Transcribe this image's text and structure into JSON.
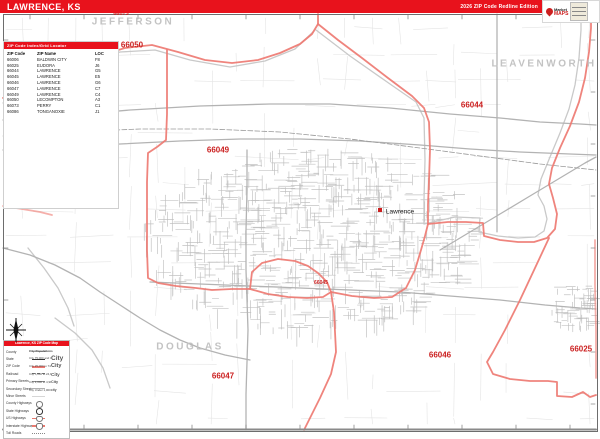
{
  "banner": {
    "title": "LAWRENCE, KS",
    "edition": "2026 ZIP Code Redline Edition",
    "color": "#e8121c"
  },
  "logo": {
    "brand_top": "Market",
    "brand_bottom": "MAPS"
  },
  "zip_table": {
    "header": "ZIP Code Index/Grid Locator",
    "columns": [
      "ZIP Code",
      "ZIP Name",
      "LOC"
    ],
    "rows": [
      [
        "66006",
        "BALDWIN CITY",
        "F8"
      ],
      [
        "66025",
        "EUDORA",
        "J6"
      ],
      [
        "66044",
        "LAWRENCE",
        "G5"
      ],
      [
        "66045",
        "LAWRENCE",
        "E5"
      ],
      [
        "66046",
        "LAWRENCE",
        "G6"
      ],
      [
        "66047",
        "LAWRENCE",
        "C7"
      ],
      [
        "66049",
        "LAWRENCE",
        "C4"
      ],
      [
        "66050",
        "LECOMPTON",
        "A3"
      ],
      [
        "66073",
        "PERRY",
        "C1"
      ],
      [
        "66086",
        "TONGANOXIE",
        "J1"
      ]
    ]
  },
  "legend": {
    "header": "Lawrence, KS ZIP Code Map",
    "items": [
      {
        "label": "County",
        "symbol": "county-line"
      },
      {
        "label": "State",
        "symbol": "state-line"
      },
      {
        "label": "ZIP Code",
        "symbol": "zip-line"
      },
      {
        "label": "Railroad",
        "symbol": "rail-line"
      },
      {
        "label": "Primary Streets",
        "symbol": "primary-line"
      },
      {
        "label": "Secondary Streets",
        "symbol": "secondary-line"
      },
      {
        "label": "Minor Streets",
        "symbol": "minor-line"
      },
      {
        "label": "County Highways",
        "symbol": "badge-oval"
      },
      {
        "label": "State Highways",
        "symbol": "badge-oval-dark"
      },
      {
        "label": "US Highways",
        "symbol": "badge-us"
      },
      {
        "label": "Interstate Highways",
        "symbol": "badge-interstate"
      },
      {
        "label": "Toll Roads",
        "symbol": "toll-line"
      }
    ],
    "city_section": {
      "title": "City Populations",
      "items": [
        {
          "label": "City 75,000 and Over",
          "sample": "City",
          "px": 6.5
        },
        {
          "label": "City 25,000 to 74,999",
          "sample": "City",
          "px": 5.5
        },
        {
          "label": "City 5,000 to 24,999",
          "sample": "City",
          "px": 4.6
        },
        {
          "label": "City 1,000 to 4,999",
          "sample": "City",
          "px": 3.8
        },
        {
          "label": "City Under 1,000",
          "sample": "city",
          "px": 3.2
        }
      ]
    }
  },
  "map": {
    "colors": {
      "boundary": "#ee7a72",
      "river": "#c9c9c9",
      "highway": "#b3b3b3",
      "railroad": "#9a9a9a",
      "county_line": "#a6a6a6",
      "rural": "#e4e4e4",
      "street": "#bcbcbc",
      "tick": "#8a8a8a",
      "zip_text": "#cb1f1f",
      "county_text": "#c3c3c3"
    },
    "counties": [
      {
        "name": "JEFFERSON",
        "x": 133,
        "y": 22
      },
      {
        "name": "LEAVENWORTH",
        "x": 544,
        "y": 64
      },
      {
        "name": "DOUGLAS",
        "x": 190,
        "y": 347
      }
    ],
    "zip_labels": [
      {
        "text": "66073",
        "x": 121,
        "y": 14,
        "size": 5.5
      },
      {
        "text": "66050",
        "x": 132,
        "y": 45,
        "size": 8
      },
      {
        "text": "66044",
        "x": 472,
        "y": 105,
        "size": 8
      },
      {
        "text": "66049",
        "x": 218,
        "y": 150,
        "size": 8
      },
      {
        "text": "66045",
        "x": 321,
        "y": 283,
        "size": 5
      },
      {
        "text": "66046",
        "x": 440,
        "y": 355,
        "size": 8
      },
      {
        "text": "66047",
        "x": 223,
        "y": 376,
        "size": 8
      },
      {
        "text": "66025",
        "x": 581,
        "y": 349,
        "size": 8
      }
    ],
    "city_labels": [
      {
        "text": "Lawrence",
        "x": 400,
        "y": 212
      }
    ],
    "city_markers": [
      {
        "x": 378,
        "y": 208
      }
    ],
    "boundaries": [
      [
        [
          3,
          98
        ],
        [
          25,
          88
        ],
        [
          48,
          76
        ],
        [
          72,
          66
        ],
        [
          98,
          56
        ],
        [
          125,
          48
        ],
        [
          152,
          45
        ],
        [
          178,
          52
        ],
        [
          205,
          60
        ],
        [
          232,
          63
        ],
        [
          258,
          60
        ],
        [
          280,
          53
        ],
        [
          300,
          44
        ],
        [
          312,
          34
        ],
        [
          318,
          24
        ],
        [
          318,
          14
        ]
      ],
      [
        [
          318,
          24
        ],
        [
          338,
          40
        ],
        [
          362,
          58
        ],
        [
          388,
          78
        ],
        [
          412,
          96
        ],
        [
          424,
          108
        ],
        [
          429,
          122
        ],
        [
          430,
          150
        ],
        [
          429,
          180
        ],
        [
          428,
          205
        ],
        [
          428,
          224
        ]
      ],
      [
        [
          167,
          50
        ],
        [
          167,
          82
        ],
        [
          167,
          114
        ],
        [
          166,
          140
        ],
        [
          157,
          147
        ],
        [
          148,
          153
        ],
        [
          147,
          182
        ],
        [
          147,
          216
        ],
        [
          147,
          250
        ],
        [
          148,
          278
        ],
        [
          158,
          283
        ],
        [
          176,
          286
        ],
        [
          196,
          288
        ],
        [
          212,
          290
        ],
        [
          232,
          289
        ],
        [
          250,
          289
        ]
      ],
      [
        [
          250,
          289
        ],
        [
          252,
          272
        ],
        [
          262,
          263
        ],
        [
          278,
          259
        ],
        [
          295,
          261
        ],
        [
          308,
          266
        ],
        [
          318,
          273
        ],
        [
          327,
          282
        ],
        [
          331,
          292
        ],
        [
          323,
          297
        ],
        [
          307,
          298
        ],
        [
          288,
          297
        ],
        [
          268,
          294
        ],
        [
          250,
          289
        ]
      ],
      [
        [
          331,
          292
        ],
        [
          334,
          312
        ],
        [
          335,
          332
        ],
        [
          336,
          352
        ],
        [
          331,
          374
        ],
        [
          320,
          398
        ],
        [
          310,
          418
        ],
        [
          304,
          430
        ]
      ],
      [
        [
          331,
          292
        ],
        [
          352,
          296
        ],
        [
          374,
          298
        ],
        [
          392,
          297
        ],
        [
          406,
          288
        ],
        [
          415,
          270
        ],
        [
          421,
          250
        ],
        [
          425,
          236
        ],
        [
          428,
          224
        ]
      ],
      [
        [
          428,
          224
        ],
        [
          448,
          222
        ],
        [
          466,
          222
        ],
        [
          483,
          223
        ],
        [
          484,
          236
        ],
        [
          500,
          240
        ],
        [
          518,
          242
        ],
        [
          534,
          242
        ],
        [
          547,
          238
        ],
        [
          555,
          229
        ],
        [
          557,
          214
        ],
        [
          553,
          198
        ],
        [
          549,
          184
        ],
        [
          552,
          168
        ],
        [
          560,
          148
        ],
        [
          570,
          126
        ],
        [
          579,
          102
        ],
        [
          585,
          78
        ],
        [
          589,
          52
        ],
        [
          591,
          28
        ],
        [
          591,
          14
        ]
      ],
      [
        [
          549,
          238
        ],
        [
          535,
          268
        ],
        [
          520,
          300
        ],
        [
          505,
          330
        ],
        [
          493,
          352
        ],
        [
          487,
          362
        ],
        [
          493,
          374
        ],
        [
          510,
          379
        ],
        [
          530,
          381
        ],
        [
          548,
          381
        ],
        [
          557,
          382
        ],
        [
          557,
          396
        ],
        [
          572,
          397
        ],
        [
          583,
          392
        ],
        [
          590,
          397
        ],
        [
          596,
          395
        ]
      ],
      [
        [
          595,
          240
        ],
        [
          595,
          285
        ],
        [
          596,
          330
        ],
        [
          596,
          378
        ]
      ],
      [
        [
          3,
          206
        ],
        [
          22,
          209
        ],
        [
          40,
          212
        ],
        [
          52,
          215
        ]
      ]
    ],
    "rivers": [
      [
        [
          3,
          103
        ],
        [
          40,
          86
        ],
        [
          80,
          66
        ],
        [
          120,
          52
        ],
        [
          155,
          50
        ],
        [
          190,
          60
        ],
        [
          230,
          67
        ],
        [
          265,
          61
        ],
        [
          295,
          49
        ],
        [
          314,
          31
        ]
      ],
      [
        [
          316,
          30
        ],
        [
          350,
          56
        ],
        [
          390,
          84
        ],
        [
          416,
          102
        ],
        [
          424,
          118
        ],
        [
          425,
          160
        ],
        [
          424,
          200
        ],
        [
          424,
          224
        ]
      ],
      [
        [
          424,
          224
        ],
        [
          455,
          217
        ],
        [
          480,
          218
        ],
        [
          479,
          232
        ],
        [
          498,
          236
        ],
        [
          518,
          238
        ],
        [
          535,
          237
        ],
        [
          544,
          231
        ],
        [
          547,
          219
        ],
        [
          544,
          206
        ],
        [
          538,
          195
        ],
        [
          541,
          179
        ],
        [
          550,
          157
        ],
        [
          560,
          133
        ],
        [
          569,
          109
        ],
        [
          575,
          85
        ],
        [
          579,
          58
        ],
        [
          581,
          30
        ],
        [
          581,
          14
        ]
      ],
      [
        [
          55,
          318
        ],
        [
          75,
          333
        ],
        [
          92,
          350
        ],
        [
          103,
          368
        ],
        [
          110,
          388
        ]
      ],
      [
        [
          28,
          248
        ],
        [
          44,
          268
        ],
        [
          58,
          288
        ],
        [
          68,
          308
        ],
        [
          74,
          326
        ]
      ]
    ],
    "highways": [
      [
        [
          3,
          150
        ],
        [
          60,
          148
        ],
        [
          120,
          144
        ],
        [
          180,
          141
        ],
        [
          240,
          139
        ],
        [
          300,
          139
        ],
        [
          360,
          141
        ],
        [
          420,
          145
        ],
        [
          470,
          149
        ],
        [
          520,
          152
        ],
        [
          570,
          154
        ],
        [
          596,
          155
        ]
      ],
      [
        [
          3,
          120
        ],
        [
          60,
          116
        ],
        [
          130,
          110
        ],
        [
          200,
          106
        ],
        [
          270,
          104
        ],
        [
          330,
          104
        ],
        [
          390,
          108
        ],
        [
          450,
          114
        ],
        [
          500,
          118
        ],
        [
          540,
          122
        ],
        [
          580,
          124
        ],
        [
          596,
          125
        ]
      ],
      [
        [
          440,
          250
        ],
        [
          470,
          232
        ],
        [
          500,
          214
        ],
        [
          530,
          196
        ],
        [
          560,
          178
        ],
        [
          585,
          163
        ],
        [
          596,
          157
        ]
      ],
      [
        [
          150,
          282
        ],
        [
          200,
          284
        ],
        [
          250,
          286
        ],
        [
          300,
          288
        ],
        [
          350,
          290
        ],
        [
          400,
          292
        ],
        [
          450,
          296
        ],
        [
          500,
          300
        ],
        [
          545,
          305
        ],
        [
          580,
          308
        ],
        [
          596,
          309
        ]
      ],
      [
        [
          247,
          150
        ],
        [
          247,
          190
        ],
        [
          246,
          230
        ],
        [
          246,
          270
        ],
        [
          247,
          300
        ],
        [
          248,
          330
        ],
        [
          247,
          362
        ],
        [
          246,
          394
        ],
        [
          246,
          430
        ]
      ],
      [
        [
          3,
          248
        ],
        [
          30,
          255
        ],
        [
          55,
          265
        ],
        [
          80,
          278
        ],
        [
          100,
          292
        ],
        [
          120,
          305
        ],
        [
          140,
          318
        ],
        [
          160,
          330
        ],
        [
          180,
          340
        ],
        [
          200,
          348
        ],
        [
          225,
          355
        ],
        [
          250,
          360
        ]
      ]
    ],
    "railroads": [
      [
        [
          3,
          136
        ],
        [
          70,
          132
        ],
        [
          140,
          129
        ],
        [
          210,
          129
        ],
        [
          280,
          132
        ],
        [
          350,
          139
        ],
        [
          420,
          148
        ],
        [
          480,
          156
        ],
        [
          540,
          164
        ],
        [
          596,
          170
        ]
      ]
    ],
    "county_lines": [
      [
        [
          497,
          14
        ],
        [
          497,
          232
        ]
      ]
    ]
  }
}
